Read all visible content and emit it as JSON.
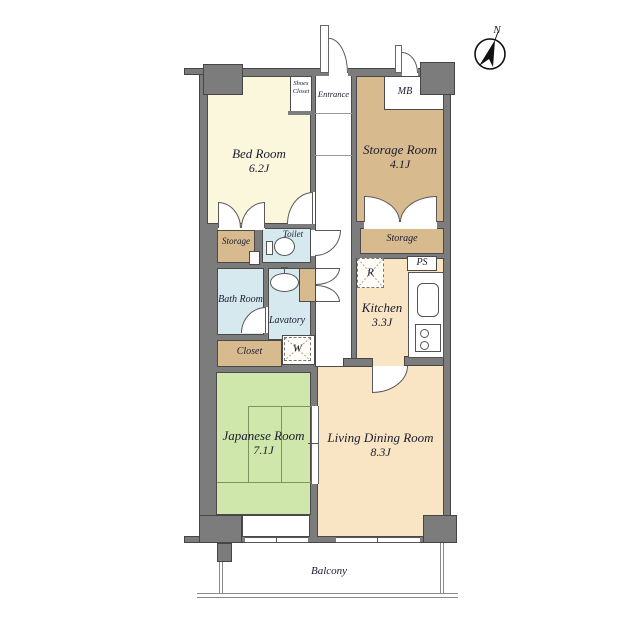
{
  "plan": {
    "compass": {
      "north_label": "N"
    },
    "rooms": {
      "bed_room": {
        "label": "Bed Room",
        "area": "6.2J"
      },
      "storage_room": {
        "label": "Storage Room",
        "area": "4.1J"
      },
      "kitchen": {
        "label": "Kitchen",
        "area": "3.3J"
      },
      "living_dining": {
        "label": "Living Dining Room",
        "area": "8.3J"
      },
      "japanese_room": {
        "label": "Japanese Room",
        "area": "7.1J"
      },
      "bath_room": {
        "label": "Bath Room"
      },
      "lavatory": {
        "label": "Lavatory"
      },
      "toilet": {
        "label": "Toilet"
      },
      "closet": {
        "label": "Closet"
      },
      "storage_left": {
        "label": "Storage"
      },
      "storage_right": {
        "label": "Storage"
      },
      "shoes_closet": {
        "label": "Shoes Closet"
      },
      "entrance": {
        "label": "Entrance"
      },
      "meter_box": {
        "label": "MB"
      },
      "pipe_space": {
        "label": "PS"
      },
      "balcony": {
        "label": "Balcony"
      }
    },
    "appliances": {
      "refrigerator": "R",
      "washing_machine": "W"
    },
    "colors": {
      "wall": "#7c7c7c",
      "bedroom_fill": "#fbf7dd",
      "storage_fill": "#d7ba8d",
      "wet_area_fill": "#d5e9ef",
      "living_fill": "#f9e5c3",
      "tatami_fill": "#cfe7aa",
      "outline": "#4a4a4a"
    }
  }
}
